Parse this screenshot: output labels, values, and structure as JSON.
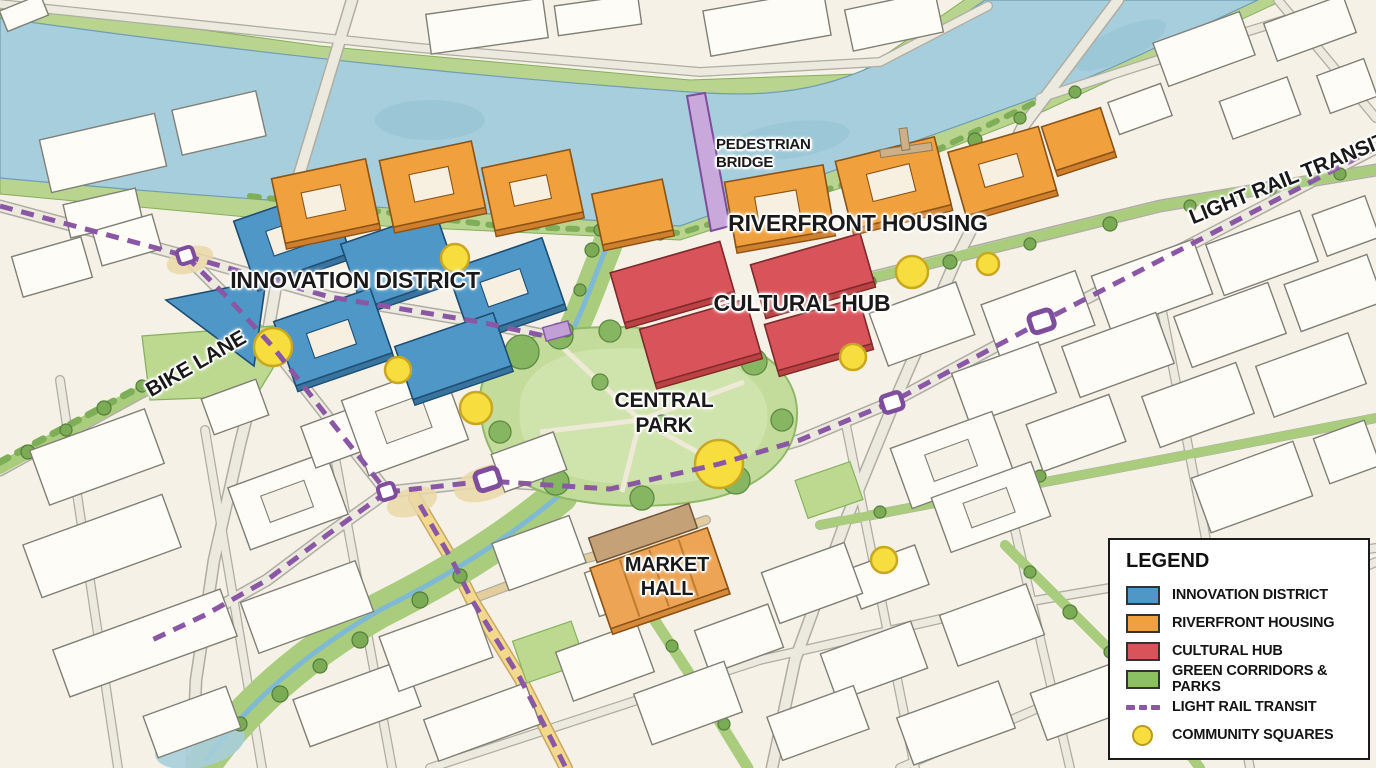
{
  "map": {
    "labels": {
      "pedestrian_bridge_line1": "PEDESTRIAN",
      "pedestrian_bridge_line2": "BRIDGE",
      "riverfront_housing": "RIVERFRONT HOUSING",
      "innovation_district": "INNOVATION DISTRICT",
      "cultural_hub": "CULTURAL HUB",
      "central_park_line1": "CENTRAL",
      "central_park_line2": "PARK",
      "market_hall_line1": "MARKET",
      "market_hall_line2": "HALL",
      "bike_lane": "BIKE LANE",
      "light_rail_transit": "LIGHT RAIL TRANSIT"
    }
  },
  "legend": {
    "title": "LEGEND",
    "items": [
      {
        "key": "innovation",
        "label": "INNOVATION DISTRICT"
      },
      {
        "key": "riverfront",
        "label": "RIVERFRONT HOUSING"
      },
      {
        "key": "cultural",
        "label": "CULTURAL HUB"
      },
      {
        "key": "green_corridors",
        "label": "GREEN CORRIDORS & PARKS"
      },
      {
        "key": "light_rail",
        "label": "LIGHT RAIL TRANSIT"
      },
      {
        "key": "community",
        "label": "COMMUNITY SQUARES"
      }
    ]
  },
  "colors": {
    "innovation": "#4E97C6",
    "riverfront": "#F0A03C",
    "cultural": "#D9535A",
    "green_corridors": "#8DC063",
    "light_rail": "#8A57A5",
    "community": "#F7DE3E",
    "river": "#A7CEDC",
    "park_green": "#C3DC9C"
  }
}
